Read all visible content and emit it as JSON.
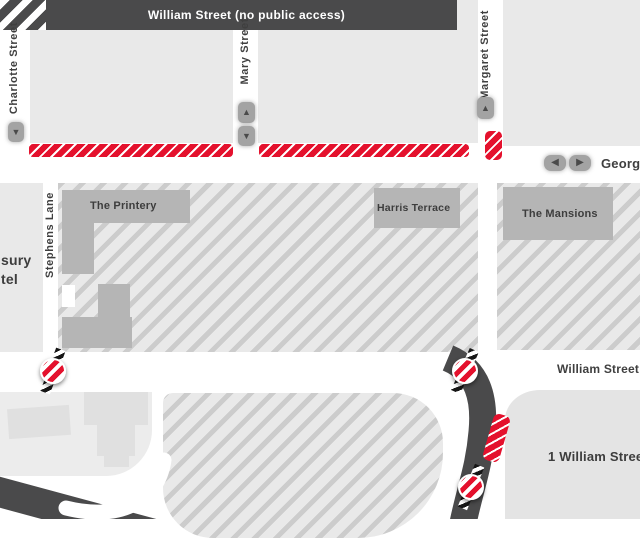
{
  "labels": {
    "charlotte_street": "Charlotte Street",
    "mary_street": "Mary Street",
    "margaret_street": "Margaret Street",
    "george_street": "George",
    "stephens_lane": "Stephens Lane",
    "william_street_closed": "William Street (no public access)",
    "william_street": "William Street",
    "the_printery": "The Printery",
    "harris_terrace": "Harris Terrace",
    "the_mansions": "The Mansions",
    "one_william_street": "1 William Street",
    "treasury_partial_line1": "sury",
    "treasury_partial_line2": "tel"
  },
  "icons": {
    "arrow_up": "▲",
    "arrow_down": "▼",
    "arrow_left": "◀",
    "arrow_right": "▶"
  },
  "colors": {
    "closure_red": "#e4112d",
    "closed_road_dark": "#4a4a4b",
    "building_gray": "#b5b5b5",
    "block_gray": "#e9e9e9",
    "hatch_stripe": "#cccccc",
    "label_text": "#3f3f3f"
  }
}
